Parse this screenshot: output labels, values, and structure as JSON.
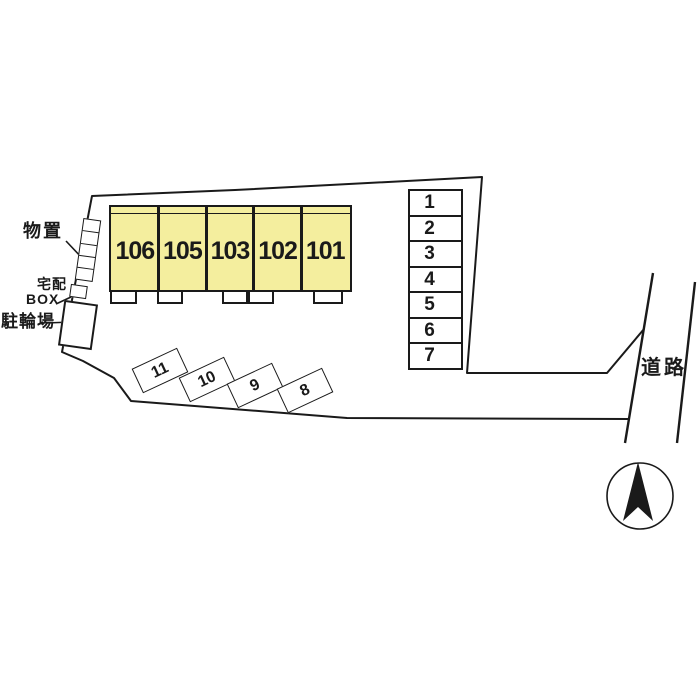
{
  "diagram_type": "property-site-plan",
  "building": {
    "units": [
      "106",
      "105",
      "103",
      "102",
      "101"
    ]
  },
  "parking_column": {
    "spaces": [
      "1",
      "2",
      "3",
      "4",
      "5",
      "6",
      "7"
    ]
  },
  "parking_angled": {
    "spaces": [
      "11",
      "10",
      "9",
      "8"
    ]
  },
  "labels": {
    "storage": "物置",
    "delivery_line1": "宅配",
    "delivery_line2": "BOX",
    "bicycle_parking": "駐輪場",
    "road": "道路"
  },
  "icons": {
    "north_arrow": "compass-north-arrow"
  },
  "colors": {
    "unit_fill": "#F4EE9E",
    "line": "#1A1A1A",
    "background": "#FFFFFF"
  }
}
